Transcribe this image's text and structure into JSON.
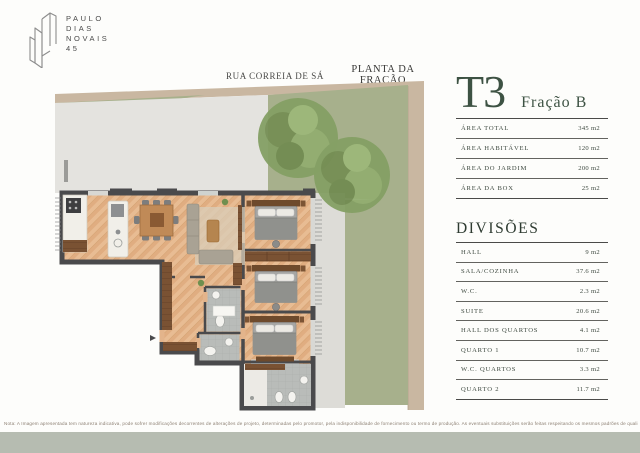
{
  "brand": {
    "lines": [
      "PAULO",
      "DIAS",
      "NOVAIS",
      "45"
    ]
  },
  "plan": {
    "street_label": "RUA CORREIA DE SÁ",
    "title": "PLANTA DA FRAÇÃO"
  },
  "panel": {
    "type_code": "T3",
    "fraction": "Fração B",
    "areas": [
      {
        "label": "ÁREA TOTAL",
        "value": "345 m2"
      },
      {
        "label": "ÁREA HABITÁVEL",
        "value": "120 m2"
      },
      {
        "label": "ÁREA DO JARDIM",
        "value": "200 m2"
      },
      {
        "label": "ÁREA DA BOX",
        "value": "25 m2"
      }
    ],
    "divisions_title": "DIVISÕES",
    "divisions": [
      {
        "label": "HALL",
        "value": "9 m2"
      },
      {
        "label": "SALA/COZINHA",
        "value": "37.6 m2"
      },
      {
        "label": "W.C.",
        "value": "2.3 m2"
      },
      {
        "label": "SUITE",
        "value": "20.6 m2"
      },
      {
        "label": "HALL DOS QUARTOS",
        "value": "4.1 m2"
      },
      {
        "label": "QUARTO 1",
        "value": "10.7 m2"
      },
      {
        "label": "W.C. QUARTOS",
        "value": "3.3 m2"
      },
      {
        "label": "QUARTO 2",
        "value": "11.7 m2"
      }
    ]
  },
  "footer": {
    "note": "Nota: A Imagem apresentada tem natureza indicativa, pode sofrer modificações decorrentes de alterações de projeto, determinadas pelo promotor, pela indisponibilidade de fornecimento ou termo de produção. As eventuais substituições serão feitas respeitando os mesmos padrões de qualidade."
  },
  "colors": {
    "title_green": "#3d5243",
    "wall_dark": "#4a4a4c",
    "wood_floor": "#e3b48b",
    "grass": "#a7b08c",
    "stone_wall": "#c9b7a1",
    "footer_bar": "#b6bcb1"
  }
}
